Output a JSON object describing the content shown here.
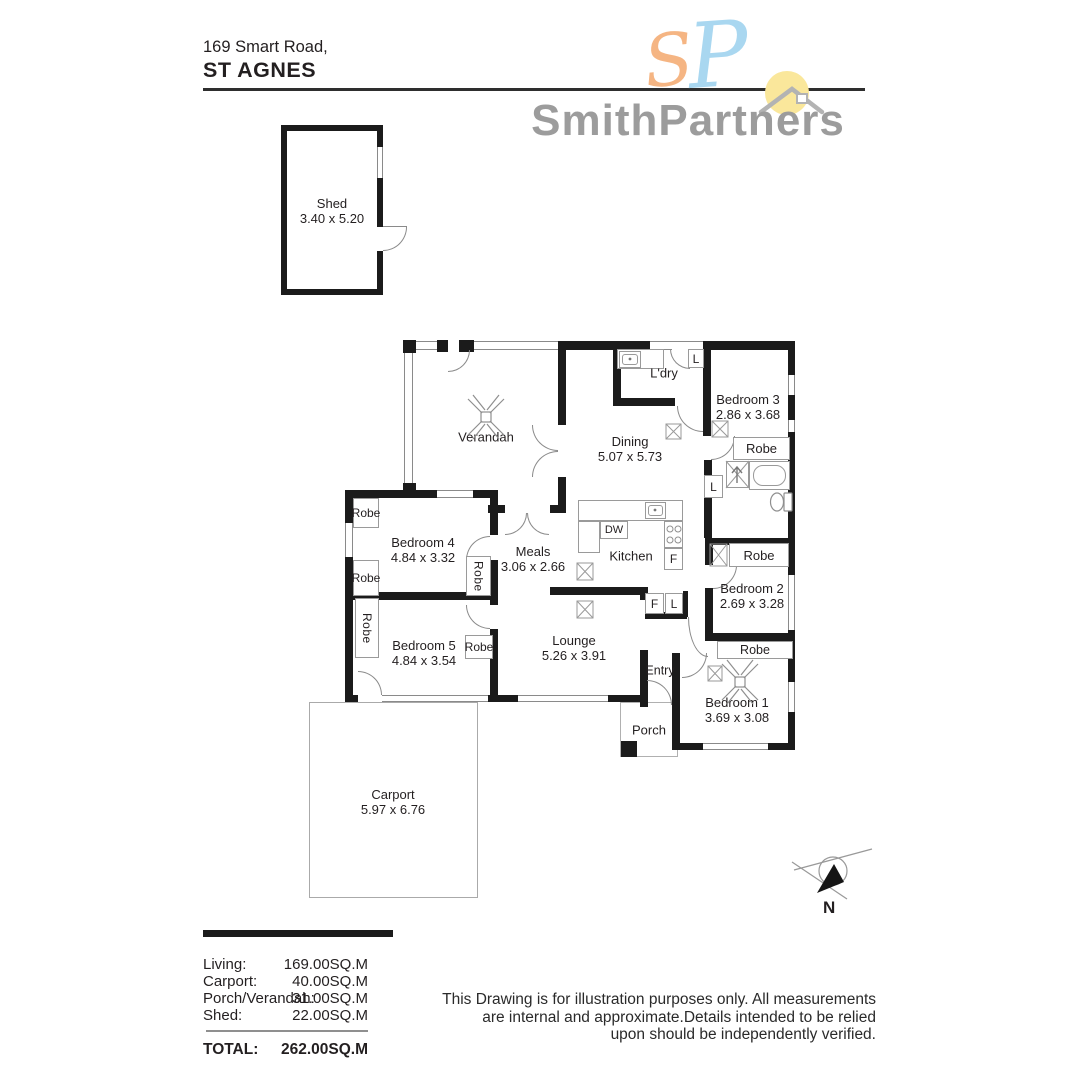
{
  "header": {
    "address_line": "169 Smart Road,",
    "suburb": "ST AGNES"
  },
  "logo": {
    "brand": "SmithPartners",
    "monogram_s": "S",
    "monogram_p": "P",
    "brand_gray": "#9c9c9c",
    "accent_orange": "#f5b583",
    "accent_blue": "#a9d7f0",
    "sun_yellow": "#fae79b"
  },
  "floorplan": {
    "rooms": [
      {
        "name": "Shed",
        "dims": "3.40 x 5.20"
      },
      {
        "name": "Verandah",
        "dims": ""
      },
      {
        "name": "L'dry",
        "dims": ""
      },
      {
        "name": "Bedroom 3",
        "dims": "2.86 x 3.68"
      },
      {
        "name": "Dining",
        "dims": "5.07 x 5.73"
      },
      {
        "name": "Bedroom 4",
        "dims": "4.84 x 3.32"
      },
      {
        "name": "Meals",
        "dims": "3.06 x 2.66"
      },
      {
        "name": "Kitchen",
        "dims": ""
      },
      {
        "name": "Bedroom 2",
        "dims": "2.69 x 3.28"
      },
      {
        "name": "Bedroom 5",
        "dims": "4.84 x 3.54"
      },
      {
        "name": "Lounge",
        "dims": "5.26 x 3.91"
      },
      {
        "name": "Entry",
        "dims": ""
      },
      {
        "name": "Bedroom 1",
        "dims": "3.69 x 3.08"
      },
      {
        "name": "Porch",
        "dims": ""
      },
      {
        "name": "Carport",
        "dims": "5.97 x 6.76"
      }
    ],
    "labels": {
      "robe": "Robe",
      "linen": "L",
      "fridge": "F",
      "dishwasher": "DW"
    }
  },
  "compass": {
    "north": "N"
  },
  "areas": {
    "rows": [
      {
        "label": "Living:",
        "value": "169.00SQ.M"
      },
      {
        "label": "Carport:",
        "value": "40.00SQ.M"
      },
      {
        "label": "Porch/Verandah:",
        "value": "31.00SQ.M"
      },
      {
        "label": "Shed:",
        "value": "22.00SQ.M"
      }
    ],
    "total_label": "TOTAL:",
    "total_value": "262.00SQ.M"
  },
  "disclaimer": {
    "line1": "This Drawing is for illustration purposes only. All measurements",
    "line2": "are internal and approximate.Details intended to be relied",
    "line3": "upon should be independently verified."
  }
}
